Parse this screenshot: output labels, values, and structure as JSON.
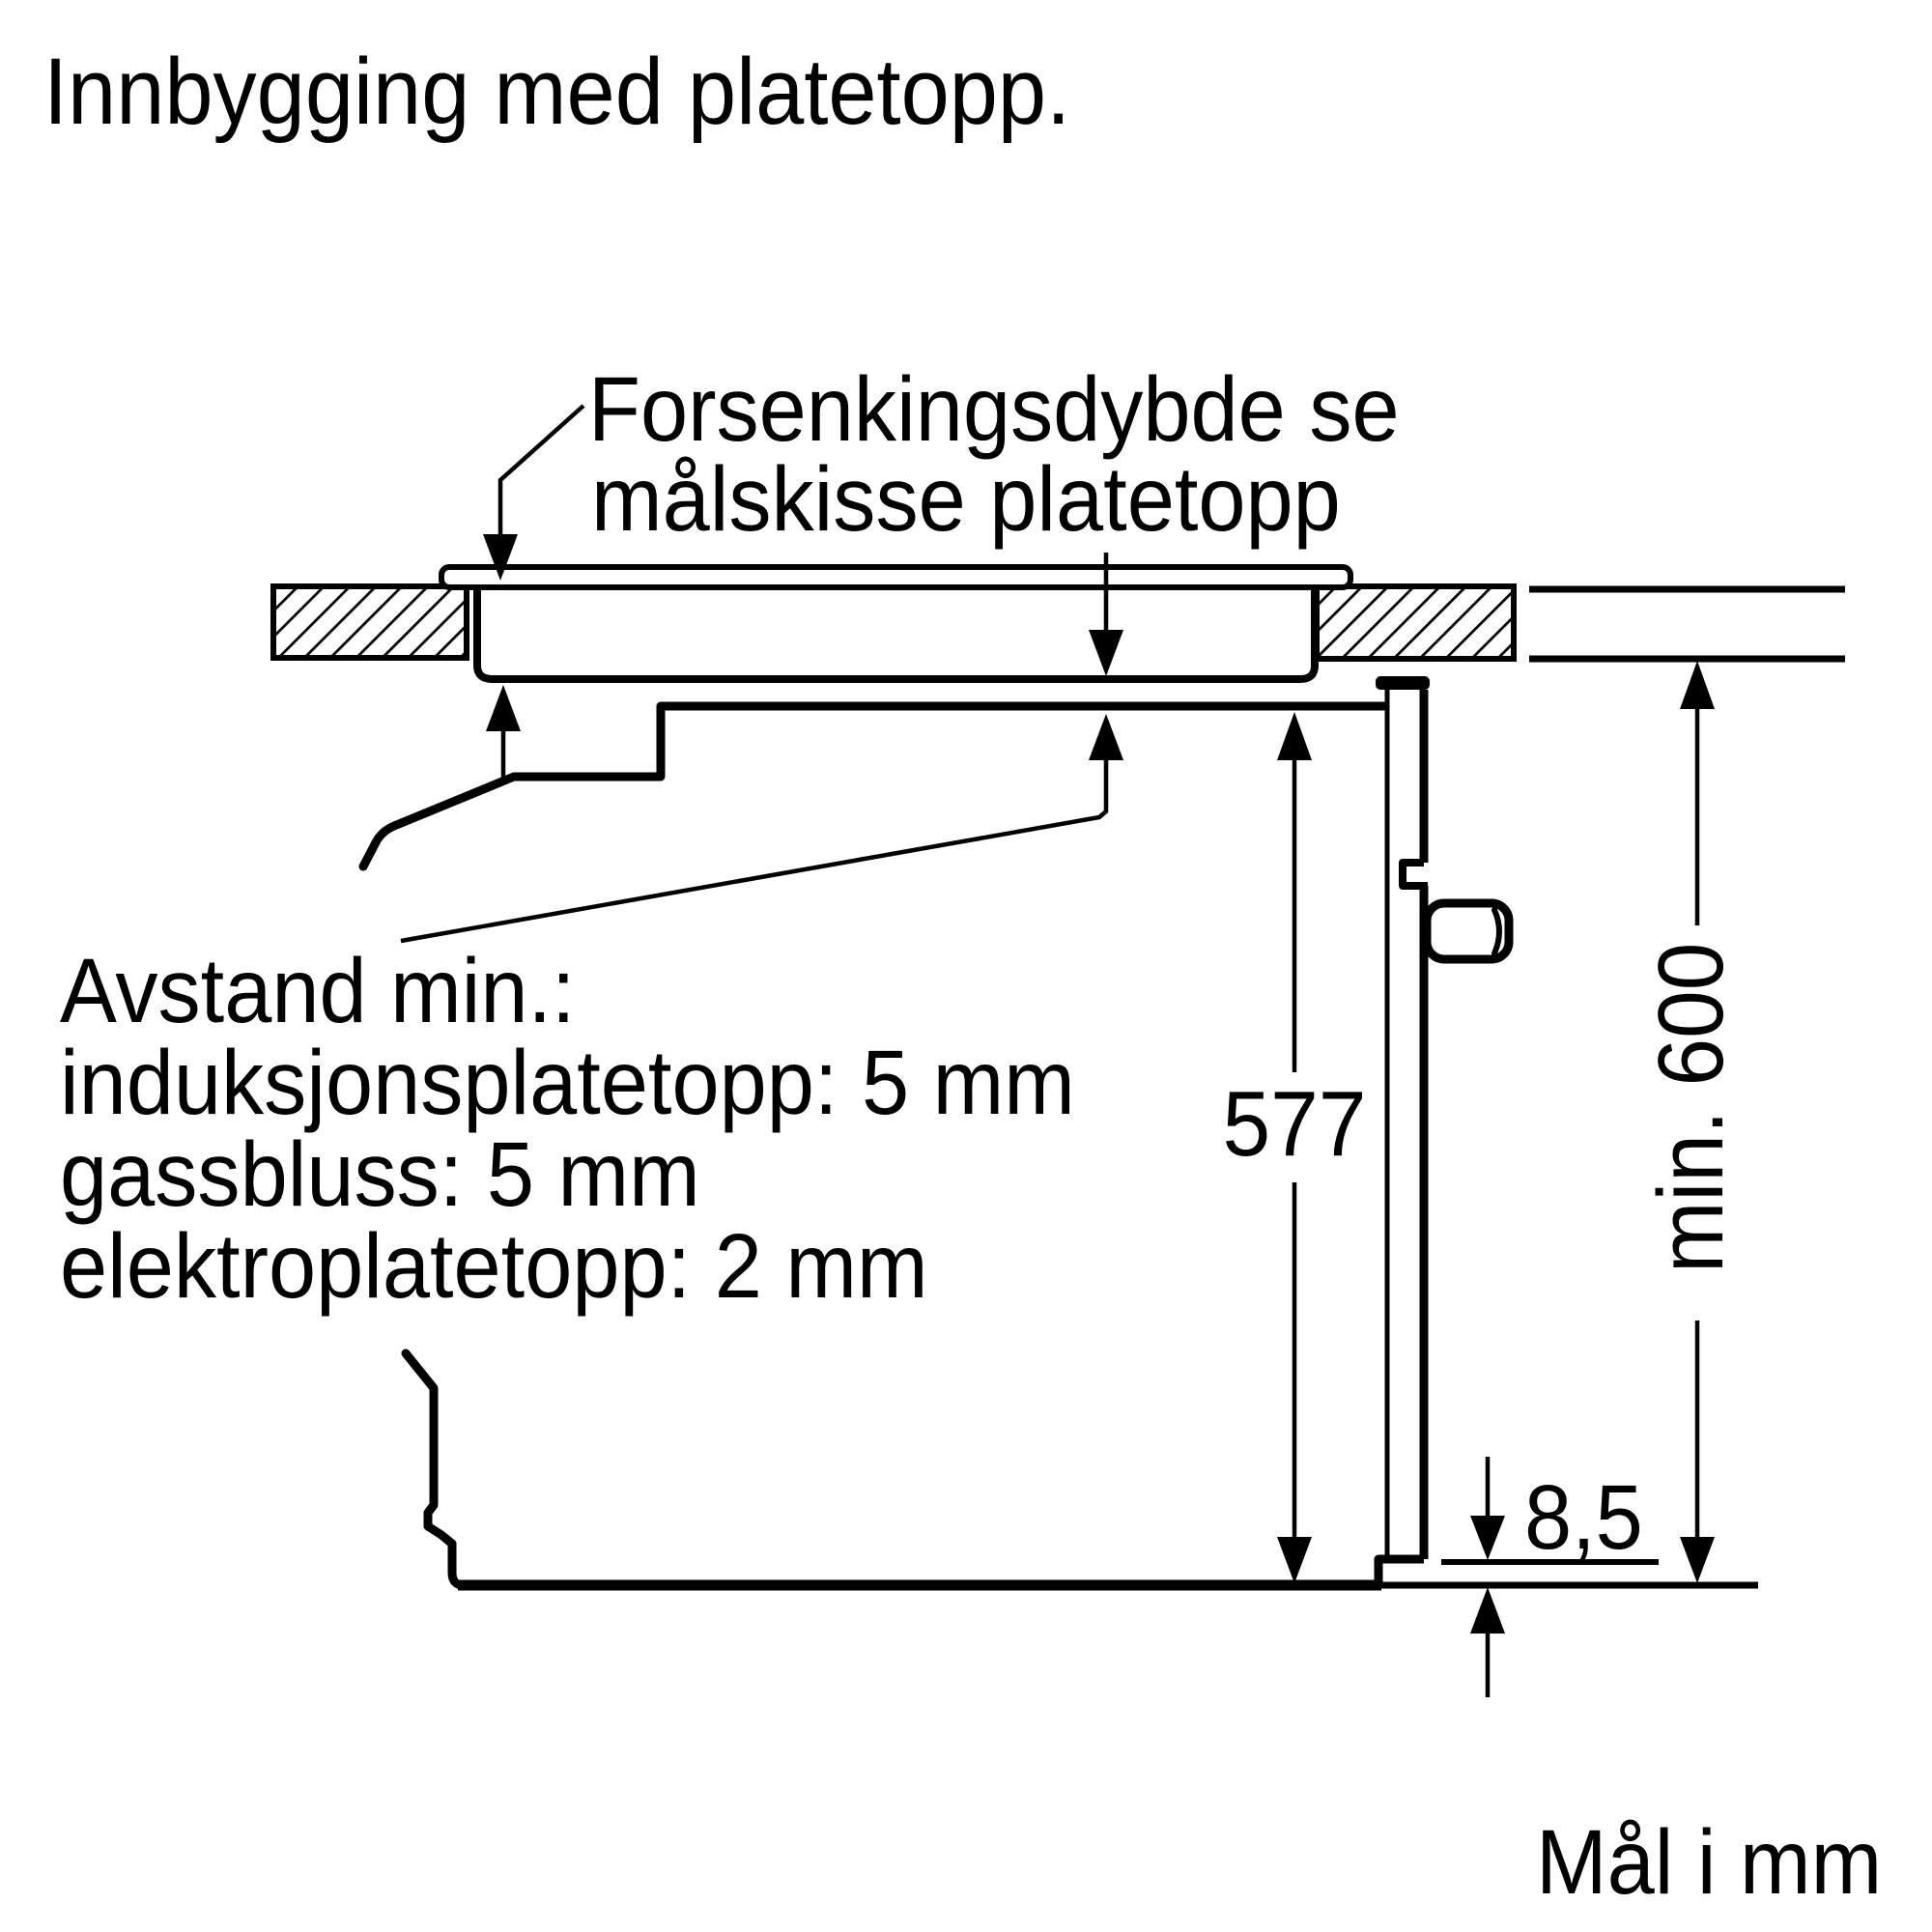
{
  "title": "Innbygging med platetopp.",
  "diagram": {
    "recess_callout": {
      "line1": "Forsenkingsdybde se",
      "line2": "målskisse platetopp"
    },
    "clearance_callout": {
      "line1": "Avstand min.:",
      "line2": "induksjonsplatetopp: 5 mm",
      "line3": "gassbluss: 5 mm",
      "line4": "elektroplatetopp: 2 mm"
    },
    "dimensions": {
      "oven_height": "577",
      "niche_height": "min. 600",
      "bottom_gap": "8,5"
    },
    "units_note": "Mål i mm"
  },
  "colors": {
    "ink": "#000000",
    "paper": "#ffffff"
  }
}
